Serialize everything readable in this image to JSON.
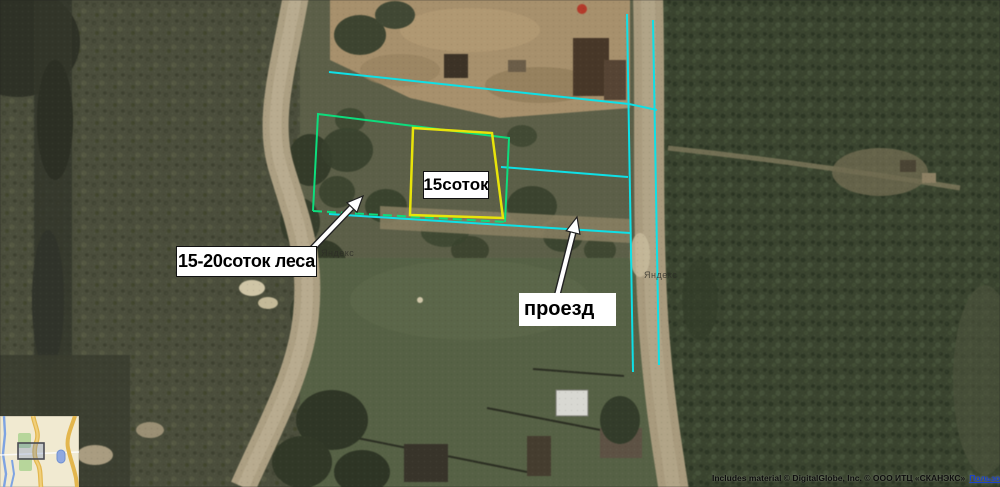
{
  "annotations": {
    "plot_label": "15соток",
    "forest_label": "15-20соток леса",
    "passage_label": "проезд"
  },
  "watermarks": {
    "center": "Яндекс",
    "right": "Яндекс"
  },
  "attribution": {
    "text": "Includes material © DigitalGlobe, Inc. © ООО ИТЦ «СКАНЭКС»",
    "link": "Пользовательское соглашение"
  },
  "colors": {
    "plot_yellow": "#e8e40a",
    "plot_green": "#0ddd7d",
    "line_cyan": "#0fe0e6",
    "link_blue": "#1a41c8",
    "label_bg": "#ffffff",
    "label_text": "#000000"
  }
}
